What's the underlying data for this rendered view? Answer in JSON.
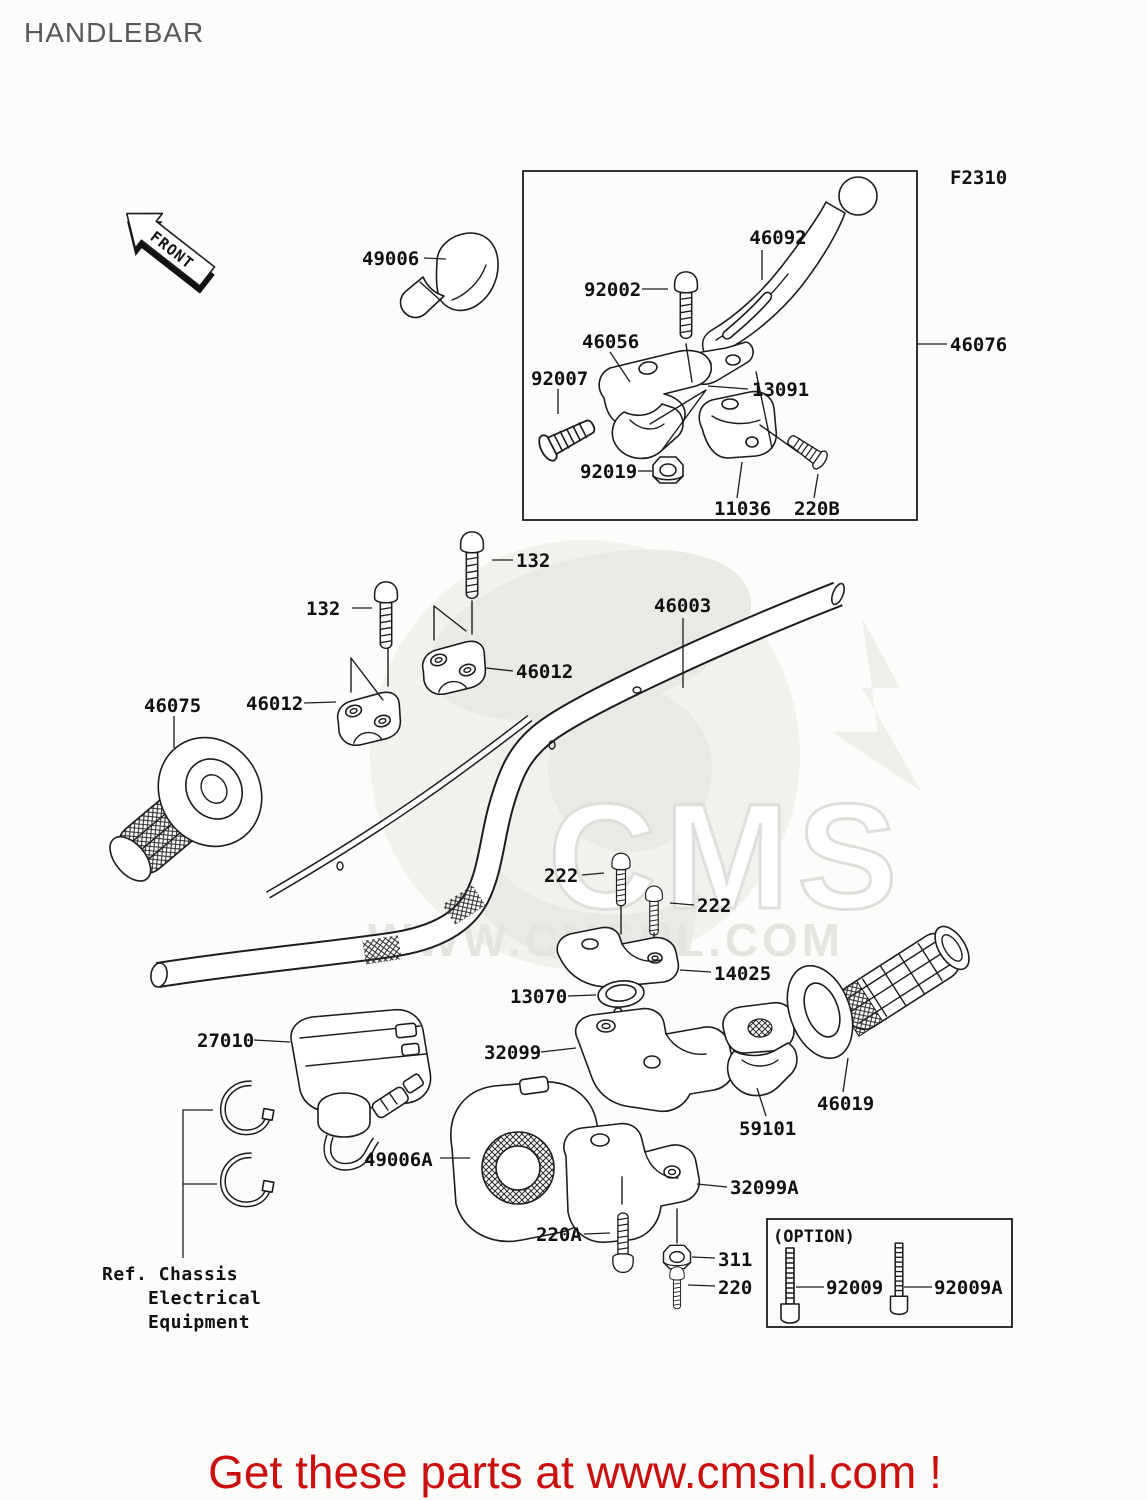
{
  "page": {
    "title": "HANDLEBAR",
    "footer": "Get these parts at www.cmsnl.com !",
    "front_label": "FRONT",
    "figure_code": "F2310",
    "option_label": "(OPTION)",
    "ref_note_lines": [
      "Ref. Chassis",
      "Electrical",
      "Equipment"
    ],
    "watermark": {
      "big": "CMS",
      "url": "WWW.CMSNL.COM"
    },
    "colors": {
      "accent_red": "#cb0e0e",
      "title_gray": "#585858",
      "line_black": "#1c1c1c",
      "watermark_gray": "#ededea",
      "background": "#fcfcfa"
    }
  },
  "labels": [
    {
      "t": "46092",
      "x": 778,
      "y": 244,
      "a": "middle",
      "line": [
        [
          762,
          250
        ],
        [
          762,
          280
        ]
      ]
    },
    {
      "t": "92002",
      "x": 584,
      "y": 296,
      "a": "start",
      "line": [
        [
          642,
          289
        ],
        [
          668,
          289
        ]
      ]
    },
    {
      "t": "46056",
      "x": 582,
      "y": 348,
      "a": "start",
      "line": [
        [
          610,
          352
        ],
        [
          630,
          382
        ]
      ]
    },
    {
      "t": "92007",
      "x": 531,
      "y": 385,
      "a": "start",
      "line": [
        [
          558,
          389
        ],
        [
          558,
          414
        ]
      ]
    },
    {
      "t": "13091",
      "x": 752,
      "y": 396,
      "a": "start",
      "line": [
        [
          748,
          389
        ],
        [
          708,
          386
        ]
      ]
    },
    {
      "t": "92019",
      "x": 580,
      "y": 478,
      "a": "start",
      "line": [
        [
          638,
          471
        ],
        [
          652,
          471
        ]
      ]
    },
    {
      "t": "11036",
      "x": 714,
      "y": 515,
      "a": "start",
      "line": [
        [
          737,
          498
        ],
        [
          742,
          462
        ]
      ]
    },
    {
      "t": "220B",
      "x": 794,
      "y": 515,
      "a": "start",
      "line": [
        [
          814,
          498
        ],
        [
          818,
          474
        ]
      ]
    },
    {
      "t": "F2310",
      "x": 950,
      "y": 184,
      "a": "start",
      "fs": 14
    },
    {
      "t": "46076",
      "x": 950,
      "y": 351,
      "a": "start",
      "line": [
        [
          947,
          344
        ],
        [
          917,
          344
        ]
      ]
    },
    {
      "t": "49006",
      "x": 362,
      "y": 265,
      "a": "start",
      "line": [
        [
          424,
          258
        ],
        [
          446,
          259
        ]
      ]
    },
    {
      "t": "132",
      "x": 516,
      "y": 567,
      "a": "start",
      "line": [
        [
          513,
          560
        ],
        [
          492,
          560
        ]
      ]
    },
    {
      "t": "132",
      "x": 306,
      "y": 615,
      "a": "start",
      "line": [
        [
          352,
          608
        ],
        [
          372,
          608
        ]
      ]
    },
    {
      "t": "46003",
      "x": 654,
      "y": 612,
      "a": "start",
      "line": [
        [
          683,
          618
        ],
        [
          683,
          688
        ]
      ]
    },
    {
      "t": "46012",
      "x": 516,
      "y": 678,
      "a": "start",
      "line": [
        [
          513,
          671
        ],
        [
          486,
          668
        ]
      ]
    },
    {
      "t": "46012",
      "x": 246,
      "y": 710,
      "a": "start",
      "line": [
        [
          304,
          703
        ],
        [
          336,
          702
        ]
      ]
    },
    {
      "t": "46075",
      "x": 144,
      "y": 712,
      "a": "start",
      "line": [
        [
          174,
          716
        ],
        [
          174,
          748
        ]
      ]
    },
    {
      "t": "222",
      "x": 544,
      "y": 882,
      "a": "start",
      "line": [
        [
          582,
          875
        ],
        [
          604,
          873
        ]
      ]
    },
    {
      "t": "222",
      "x": 697,
      "y": 912,
      "a": "start",
      "line": [
        [
          694,
          905
        ],
        [
          670,
          903
        ]
      ]
    },
    {
      "t": "14025",
      "x": 714,
      "y": 980,
      "a": "start",
      "line": [
        [
          711,
          972
        ],
        [
          680,
          970
        ]
      ]
    },
    {
      "t": "13070",
      "x": 510,
      "y": 1003,
      "a": "start",
      "line": [
        [
          568,
          996
        ],
        [
          596,
          995
        ]
      ]
    },
    {
      "t": "27010",
      "x": 197,
      "y": 1047,
      "a": "start",
      "line": [
        [
          254,
          1040
        ],
        [
          290,
          1042
        ]
      ]
    },
    {
      "t": "32099",
      "x": 484,
      "y": 1059,
      "a": "start",
      "line": [
        [
          541,
          1052
        ],
        [
          576,
          1048
        ]
      ]
    },
    {
      "t": "59101",
      "x": 739,
      "y": 1135,
      "a": "start",
      "line": [
        [
          766,
          1116
        ],
        [
          757,
          1088
        ]
      ]
    },
    {
      "t": "46019",
      "x": 817,
      "y": 1110,
      "a": "start",
      "line": [
        [
          843,
          1092
        ],
        [
          848,
          1058
        ]
      ]
    },
    {
      "t": "49006A",
      "x": 364,
      "y": 1166,
      "a": "start",
      "line": [
        [
          440,
          1158
        ],
        [
          470,
          1158
        ]
      ]
    },
    {
      "t": "32099A",
      "x": 730,
      "y": 1194,
      "a": "start",
      "line": [
        [
          727,
          1187
        ],
        [
          697,
          1184
        ]
      ]
    },
    {
      "t": "220A",
      "x": 536,
      "y": 1241,
      "a": "start",
      "line": [
        [
          584,
          1234
        ],
        [
          610,
          1233
        ]
      ]
    },
    {
      "t": "311",
      "x": 718,
      "y": 1266,
      "a": "start",
      "line": [
        [
          715,
          1258
        ],
        [
          692,
          1257
        ]
      ]
    },
    {
      "t": "220",
      "x": 718,
      "y": 1294,
      "a": "start",
      "line": [
        [
          715,
          1286
        ],
        [
          688,
          1285
        ]
      ]
    },
    {
      "t": "92009",
      "x": 826,
      "y": 1294,
      "a": "start",
      "line": [
        [
          824,
          1287
        ],
        [
          796,
          1287
        ]
      ]
    },
    {
      "t": "92009A",
      "x": 934,
      "y": 1294,
      "a": "start",
      "line": [
        [
          932,
          1287
        ],
        [
          904,
          1287
        ]
      ]
    },
    {
      "t": "",
      "line": [
        [
          213,
          1110
        ],
        [
          183,
          1110
        ],
        [
          183,
          1258
        ]
      ]
    },
    {
      "t": "",
      "line": [
        [
          217,
          1184
        ],
        [
          183,
          1184
        ]
      ]
    }
  ]
}
